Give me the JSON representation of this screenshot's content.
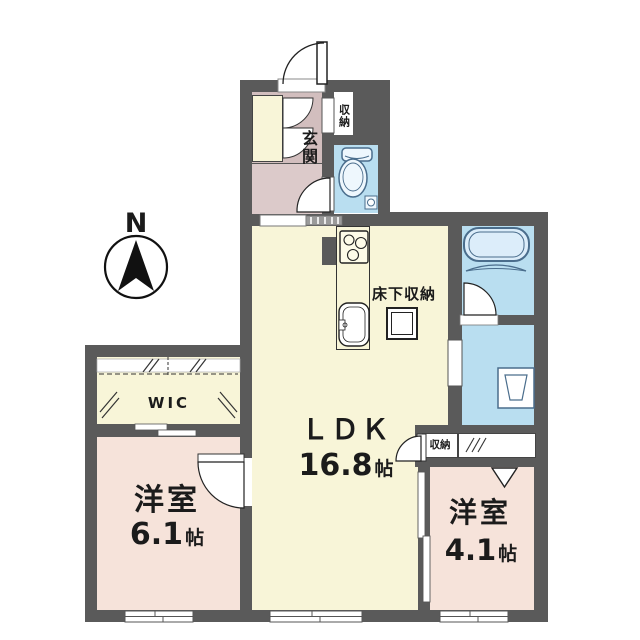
{
  "plan": {
    "compass": {
      "label": "N"
    },
    "entrance": {
      "label": "玄関"
    },
    "entrance_storage": {
      "label": "収納"
    },
    "ldk": {
      "label": "ＬＤＫ",
      "size_value": "16.8",
      "size_unit": "帖"
    },
    "underfloor_storage": {
      "label": "床下収納"
    },
    "wic": {
      "label": "WIC"
    },
    "bedroom_left": {
      "label": "洋室",
      "size_value": "6.1",
      "size_unit": "帖"
    },
    "bedroom_right": {
      "label": "洋室",
      "size_value": "4.1",
      "size_unit": "帖"
    },
    "bedroom_right_storage": {
      "label": "収納"
    },
    "colors": {
      "wall": "#5a5a5a",
      "ldk_floor": "#f8f5d8",
      "bedroom_floor": "#f6e3da",
      "entrance_floor_upper": "#d2bebe",
      "entrance_floor_lower": "#dccaca",
      "wet_area_floor": "#b9def0",
      "fixture_outline": "#4a6d8c"
    }
  }
}
